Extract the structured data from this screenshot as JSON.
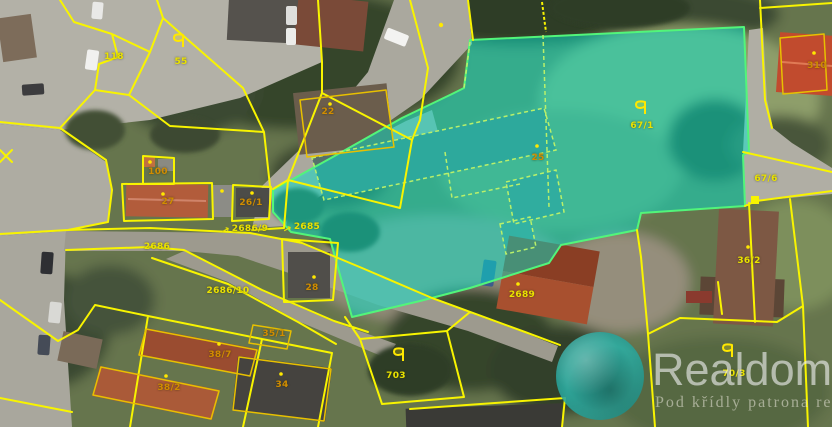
{
  "map": {
    "labels": [
      {
        "text": "118",
        "kind": "parcel"
      },
      {
        "text": "55",
        "kind": "parcel"
      },
      {
        "text": "22",
        "kind": "building"
      },
      {
        "text": "100",
        "kind": "building"
      },
      {
        "text": "27",
        "kind": "building"
      },
      {
        "text": "26/1",
        "kind": "building"
      },
      {
        "text": "2686/9",
        "kind": "parcel"
      },
      {
        "text": "2685",
        "kind": "parcel"
      },
      {
        "text": "2686",
        "kind": "parcel"
      },
      {
        "text": "2686/10",
        "kind": "parcel"
      },
      {
        "text": "28",
        "kind": "building"
      },
      {
        "text": "25",
        "kind": "building"
      },
      {
        "text": "67/1",
        "kind": "parcel"
      },
      {
        "text": "310",
        "kind": "building"
      },
      {
        "text": "67/6",
        "kind": "parcel"
      },
      {
        "text": "36/2",
        "kind": "parcel"
      },
      {
        "text": "2689",
        "kind": "parcel"
      },
      {
        "text": "703",
        "kind": "parcel"
      },
      {
        "text": "70/3",
        "kind": "parcel"
      },
      {
        "text": "38/7",
        "kind": "building"
      },
      {
        "text": "38/2",
        "kind": "building"
      },
      {
        "text": "34",
        "kind": "building"
      },
      {
        "text": "35/1",
        "kind": "building"
      }
    ],
    "arrows": {
      "glyph": "↗"
    },
    "colors": {
      "parcel_line": "#f8f400",
      "parcel_label": "#eae200",
      "building_label": "#d18c00",
      "highlight_fill": "#00e8d2",
      "highlight_border": "#52f57a"
    }
  },
  "watermark": {
    "brand": "Realdomus",
    "tagline": "Pod křídly patrona real",
    "logo_color": "#2ba8a0"
  }
}
